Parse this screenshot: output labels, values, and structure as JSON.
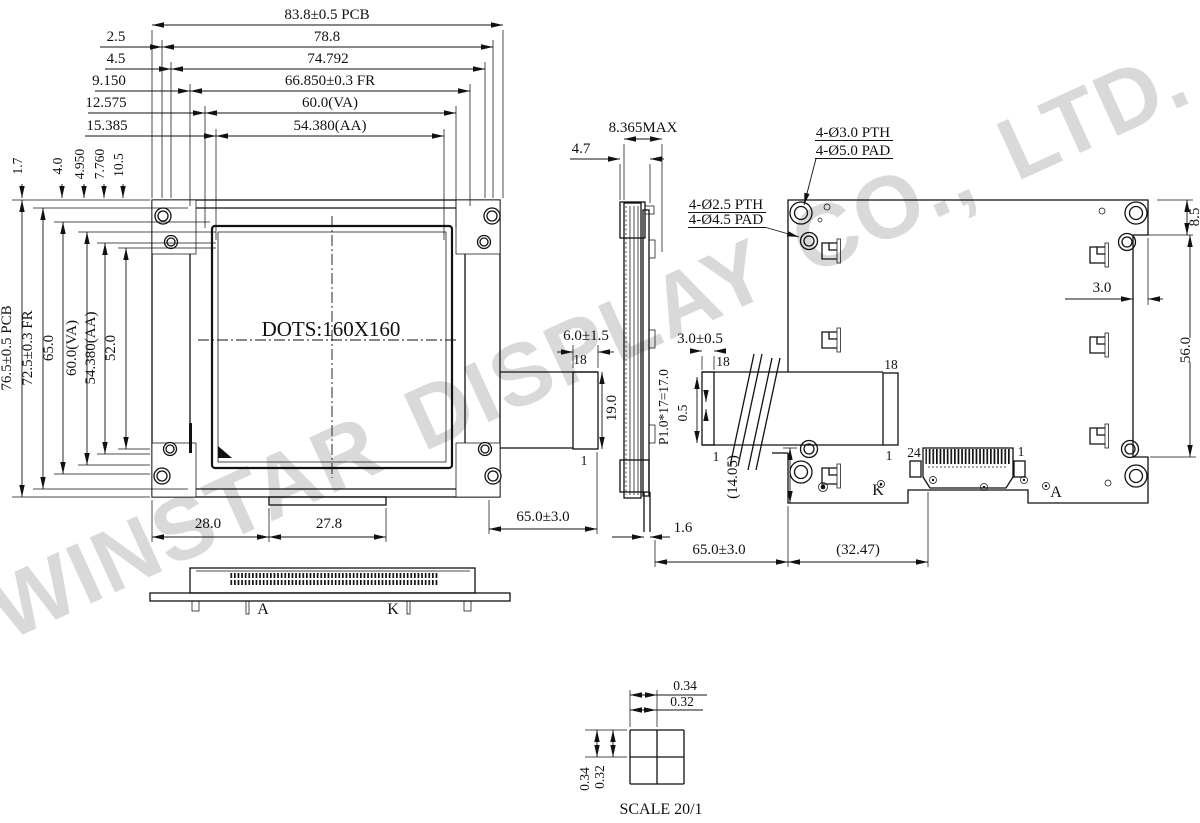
{
  "watermark": {
    "text": "WINSTAR DISPLAY CO., LTD.",
    "color": "#d9d9d9"
  },
  "front_view": {
    "dots_label": "DOTS:160X160",
    "top_dims": {
      "pcb_w": "83.8±0.5 PCB",
      "off1": "2.5",
      "w1": "78.8",
      "off2": "4.5",
      "w2": "74.792",
      "off3": "9.150",
      "fr_w": "66.850±0.3 FR",
      "off4": "12.575",
      "va_w": "60.0(VA)",
      "off5": "15.385",
      "aa_w": "54.380(AA)"
    },
    "corner_dims": {
      "d1": "1.7",
      "d2": "4.0",
      "d3": "4.950",
      "d4": "7.760",
      "d5": "10.5"
    },
    "left_dims": {
      "pcb_h": "76.5±0.5 PCB",
      "fr_h": "72.5±0.3 FR",
      "h1": "65.0",
      "va_h": "60.0(VA)",
      "aa_h": "54.380(AA)",
      "h2": "52.0"
    },
    "bottom_dims": {
      "left": "28.0",
      "right": "27.8"
    }
  },
  "left_fpc": {
    "width": "6.0±1.5",
    "pin_first": "18",
    "height": "19.0",
    "pin_last": "1",
    "length": "65.0±3.0"
  },
  "side_view": {
    "thickness_max": "8.365MAX",
    "thickness": "4.7",
    "fpc_thickness": "1.6"
  },
  "callouts": {
    "small_hole_line1": "4-Ø2.5 PTH",
    "small_hole_line2": "4-Ø4.5 PAD",
    "big_hole_line1": "4-Ø3.0 PTH",
    "big_hole_line2": "4-Ø5.0 PAD"
  },
  "back_view": {
    "right_dims": {
      "top": "8.5",
      "edge": "3.0",
      "height": "56.0"
    },
    "fpc": {
      "width": "3.0±0.5",
      "pin_first": "18",
      "pin_last": "1",
      "pitch": "P1.0*17=17.0",
      "pin_w": "0.5",
      "drop": "(14.05)",
      "length": "65.0±3.0",
      "conn_offset": "(32.47)",
      "board_pin_first": "18",
      "board_pin_last": "1"
    },
    "connector": {
      "pin_first": "24",
      "pin_last": "1"
    },
    "labels": {
      "cathode": "K",
      "anode": "A"
    }
  },
  "bottom_view": {
    "anode": "A",
    "cathode": "K"
  },
  "dot_detail": {
    "pitch_h": "0.34",
    "dot_w": "0.32",
    "pitch_v": "0.34",
    "dot_h": "0.32",
    "scale": "SCALE 20/1"
  }
}
